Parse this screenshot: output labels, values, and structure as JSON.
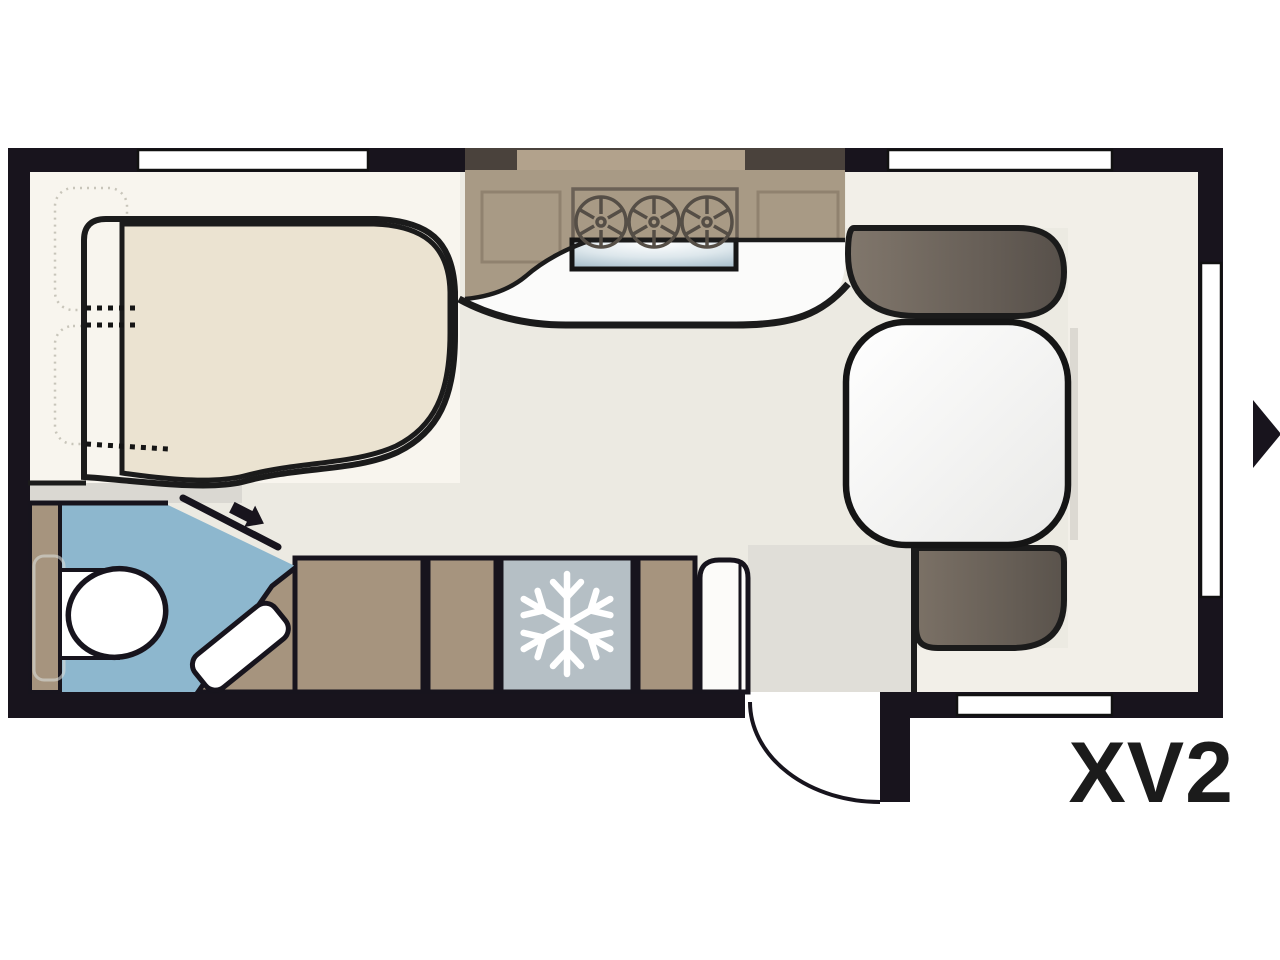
{
  "floorplan": {
    "model": "XV2"
  },
  "icons": [
    {
      "name": "snowflake-icon",
      "meaning": "refrigerator-freezer"
    },
    {
      "name": "entry-direction-arrow-icon",
      "meaning": "caravan entry side marker, points right"
    },
    {
      "name": "bathroom-door-arrow-icon",
      "meaning": "sliding door opening direction"
    },
    {
      "name": "stove-burner-icon",
      "meaning": "gas hob burner, three burners"
    },
    {
      "name": "door-swing-arc",
      "meaning": "entry door opening outward"
    }
  ],
  "rooms": [
    {
      "name": "bed-area",
      "position": "front-left"
    },
    {
      "name": "kitchen",
      "position": "top-center"
    },
    {
      "name": "dinette",
      "position": "right"
    },
    {
      "name": "bathroom",
      "position": "bottom-left"
    },
    {
      "name": "wardrobe-cabinets",
      "position": "bottom-center"
    },
    {
      "name": "refrigerator",
      "position": "bottom-center"
    },
    {
      "name": "entry-door",
      "position": "bottom-right"
    }
  ],
  "colors": {
    "canvas": "#ffffff",
    "wall": "#18141d",
    "outline": "#1b1b1b",
    "floor": "#eceae2",
    "floorLight": "#f8f5ee",
    "floorCream": "#f2efe8",
    "floorGray": "#dad8d2",
    "vestibule": "#e0ded8",
    "mattress": "#ebe3d1",
    "kitchenBrown": "#a89a85",
    "kitchenDarkBand": "#4a423c",
    "kitchenWindowStrip": "#b2a28c",
    "cabinetBrown": "#a6947e",
    "seatDark": "#57504a",
    "seatLight": "#80766b",
    "bathBlue": "#8db7ce",
    "fridgeGray": "#b5bfc5",
    "sinkBlue": "#b3c8d4",
    "white": "#ffffff",
    "label": "#1b1b1b"
  }
}
